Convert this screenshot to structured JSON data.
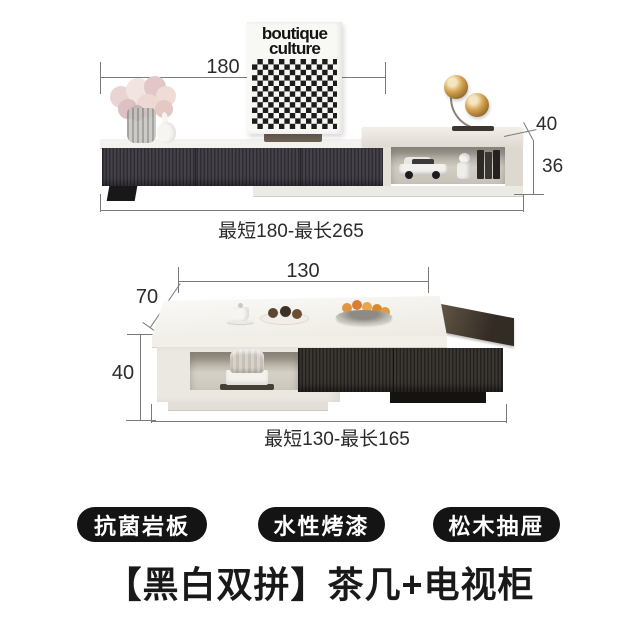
{
  "title": "【黑白双拼】茶几+电视柜",
  "badges": [
    {
      "label": "抗菌岩板"
    },
    {
      "label": "水性烤漆"
    },
    {
      "label": "松木抽屉"
    }
  ],
  "tv_stand": {
    "poster": {
      "line1": "boutique",
      "line2": "culture"
    },
    "width_label": "180",
    "depth_label": "40",
    "height_label": "36",
    "range_label": "最短180-最长265"
  },
  "coffee_table": {
    "width_label": "130",
    "depth_label": "70",
    "height_label": "40",
    "range_label": "最短130-最长165"
  },
  "colors": {
    "badge_background": "#141414",
    "cabinet_dark": "#3a363c",
    "cabinet_light": "#efece6",
    "dimension_line": "#7a7a7a",
    "lamp_gold": "#d6a452",
    "background": "#ffffff"
  }
}
